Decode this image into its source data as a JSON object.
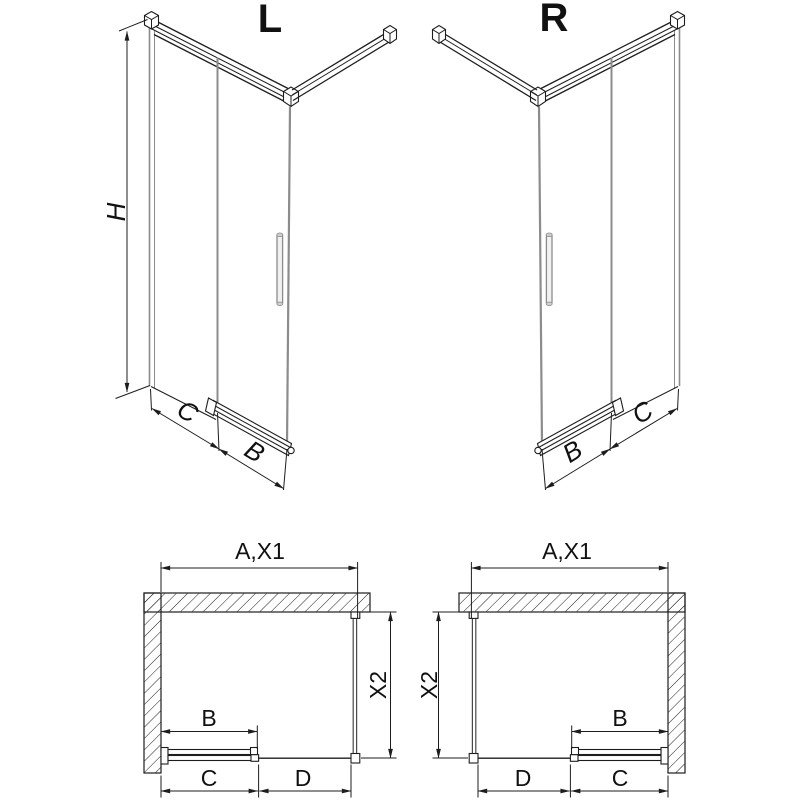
{
  "colors": {
    "line": "#1d1d1d",
    "glass_edge": "#8c8c8c",
    "background": "#ffffff",
    "text": "#111111"
  },
  "iso_left": {
    "title": "L",
    "dim_height": "H",
    "dim_panel": "C",
    "dim_door": "B"
  },
  "iso_right": {
    "title": "R",
    "dim_panel": "C",
    "dim_door": "B"
  },
  "plan_left": {
    "dim_width": "A,X1",
    "dim_depth": "X2",
    "dim_door": "B",
    "dim_door_zone": "C",
    "dim_fixed_zone": "D"
  },
  "plan_right": {
    "dim_width": "A,X1",
    "dim_depth": "X2",
    "dim_door": "B",
    "dim_door_zone": "C",
    "dim_fixed_zone": "D"
  }
}
